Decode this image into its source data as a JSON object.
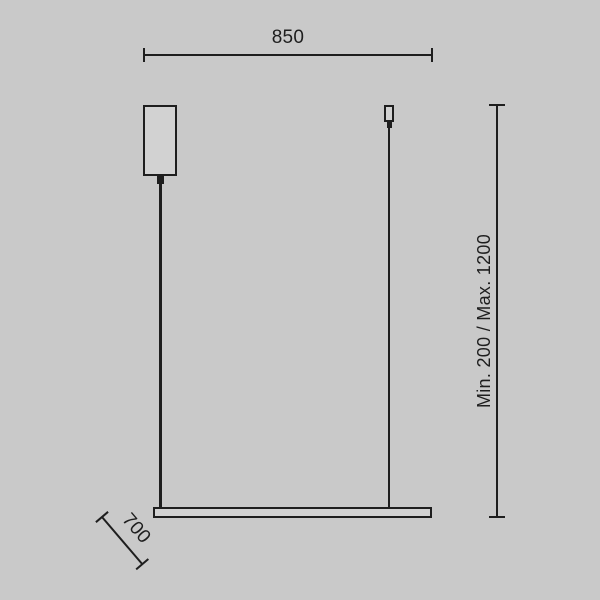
{
  "canvas": {
    "background_color": "#c9c9c9",
    "line_color": "#1e1e1e",
    "fixture_fill_color": "#d2d2d2"
  },
  "diagram": {
    "type": "pendant-lamp-dimension-drawing",
    "dimension_labels": {
      "width": "850",
      "height_range": "Min. 200 / Max. 1200",
      "depth": "700"
    }
  }
}
